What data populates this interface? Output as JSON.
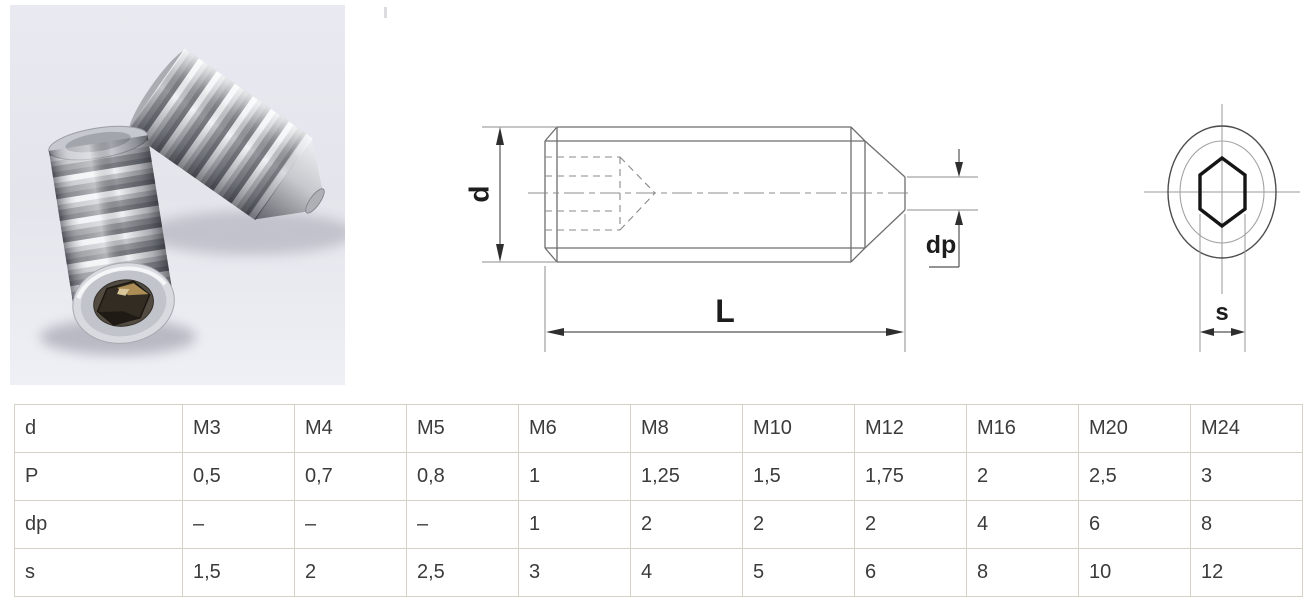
{
  "photo": {
    "name": "stainless-steel-hex-socket-cone-point-set-screws"
  },
  "drawing": {
    "side_view": {
      "diameter_label": "d",
      "length_label": "L",
      "point_label": "dp"
    },
    "end_view": {
      "socket_label": "s"
    }
  },
  "table": {
    "rows": [
      {
        "label": "d",
        "values": [
          "M3",
          "M4",
          "M5",
          "M6",
          "M8",
          "M10",
          "M12",
          "M16",
          "M20",
          "M24"
        ]
      },
      {
        "label": "P",
        "values": [
          "0,5",
          "0,7",
          "0,8",
          "1",
          "1,25",
          "1,5",
          "1,75",
          "2",
          "2,5",
          "3"
        ]
      },
      {
        "label": "dp",
        "values": [
          "–",
          "–",
          "–",
          "1",
          "2",
          "2",
          "2",
          "4",
          "6",
          "8"
        ]
      },
      {
        "label": "s",
        "values": [
          "1,5",
          "2",
          "2,5",
          "3",
          "4",
          "5",
          "6",
          "8",
          "10",
          "12"
        ]
      }
    ]
  },
  "colors": {
    "table_border": "#d6d1c5",
    "table_text": "#3b3b3b",
    "drawing_line": "#6e6e6e",
    "dimension_line": "#8c8c8c",
    "label_text": "#1d1d1d",
    "photo_background": "#e8e9ef"
  }
}
